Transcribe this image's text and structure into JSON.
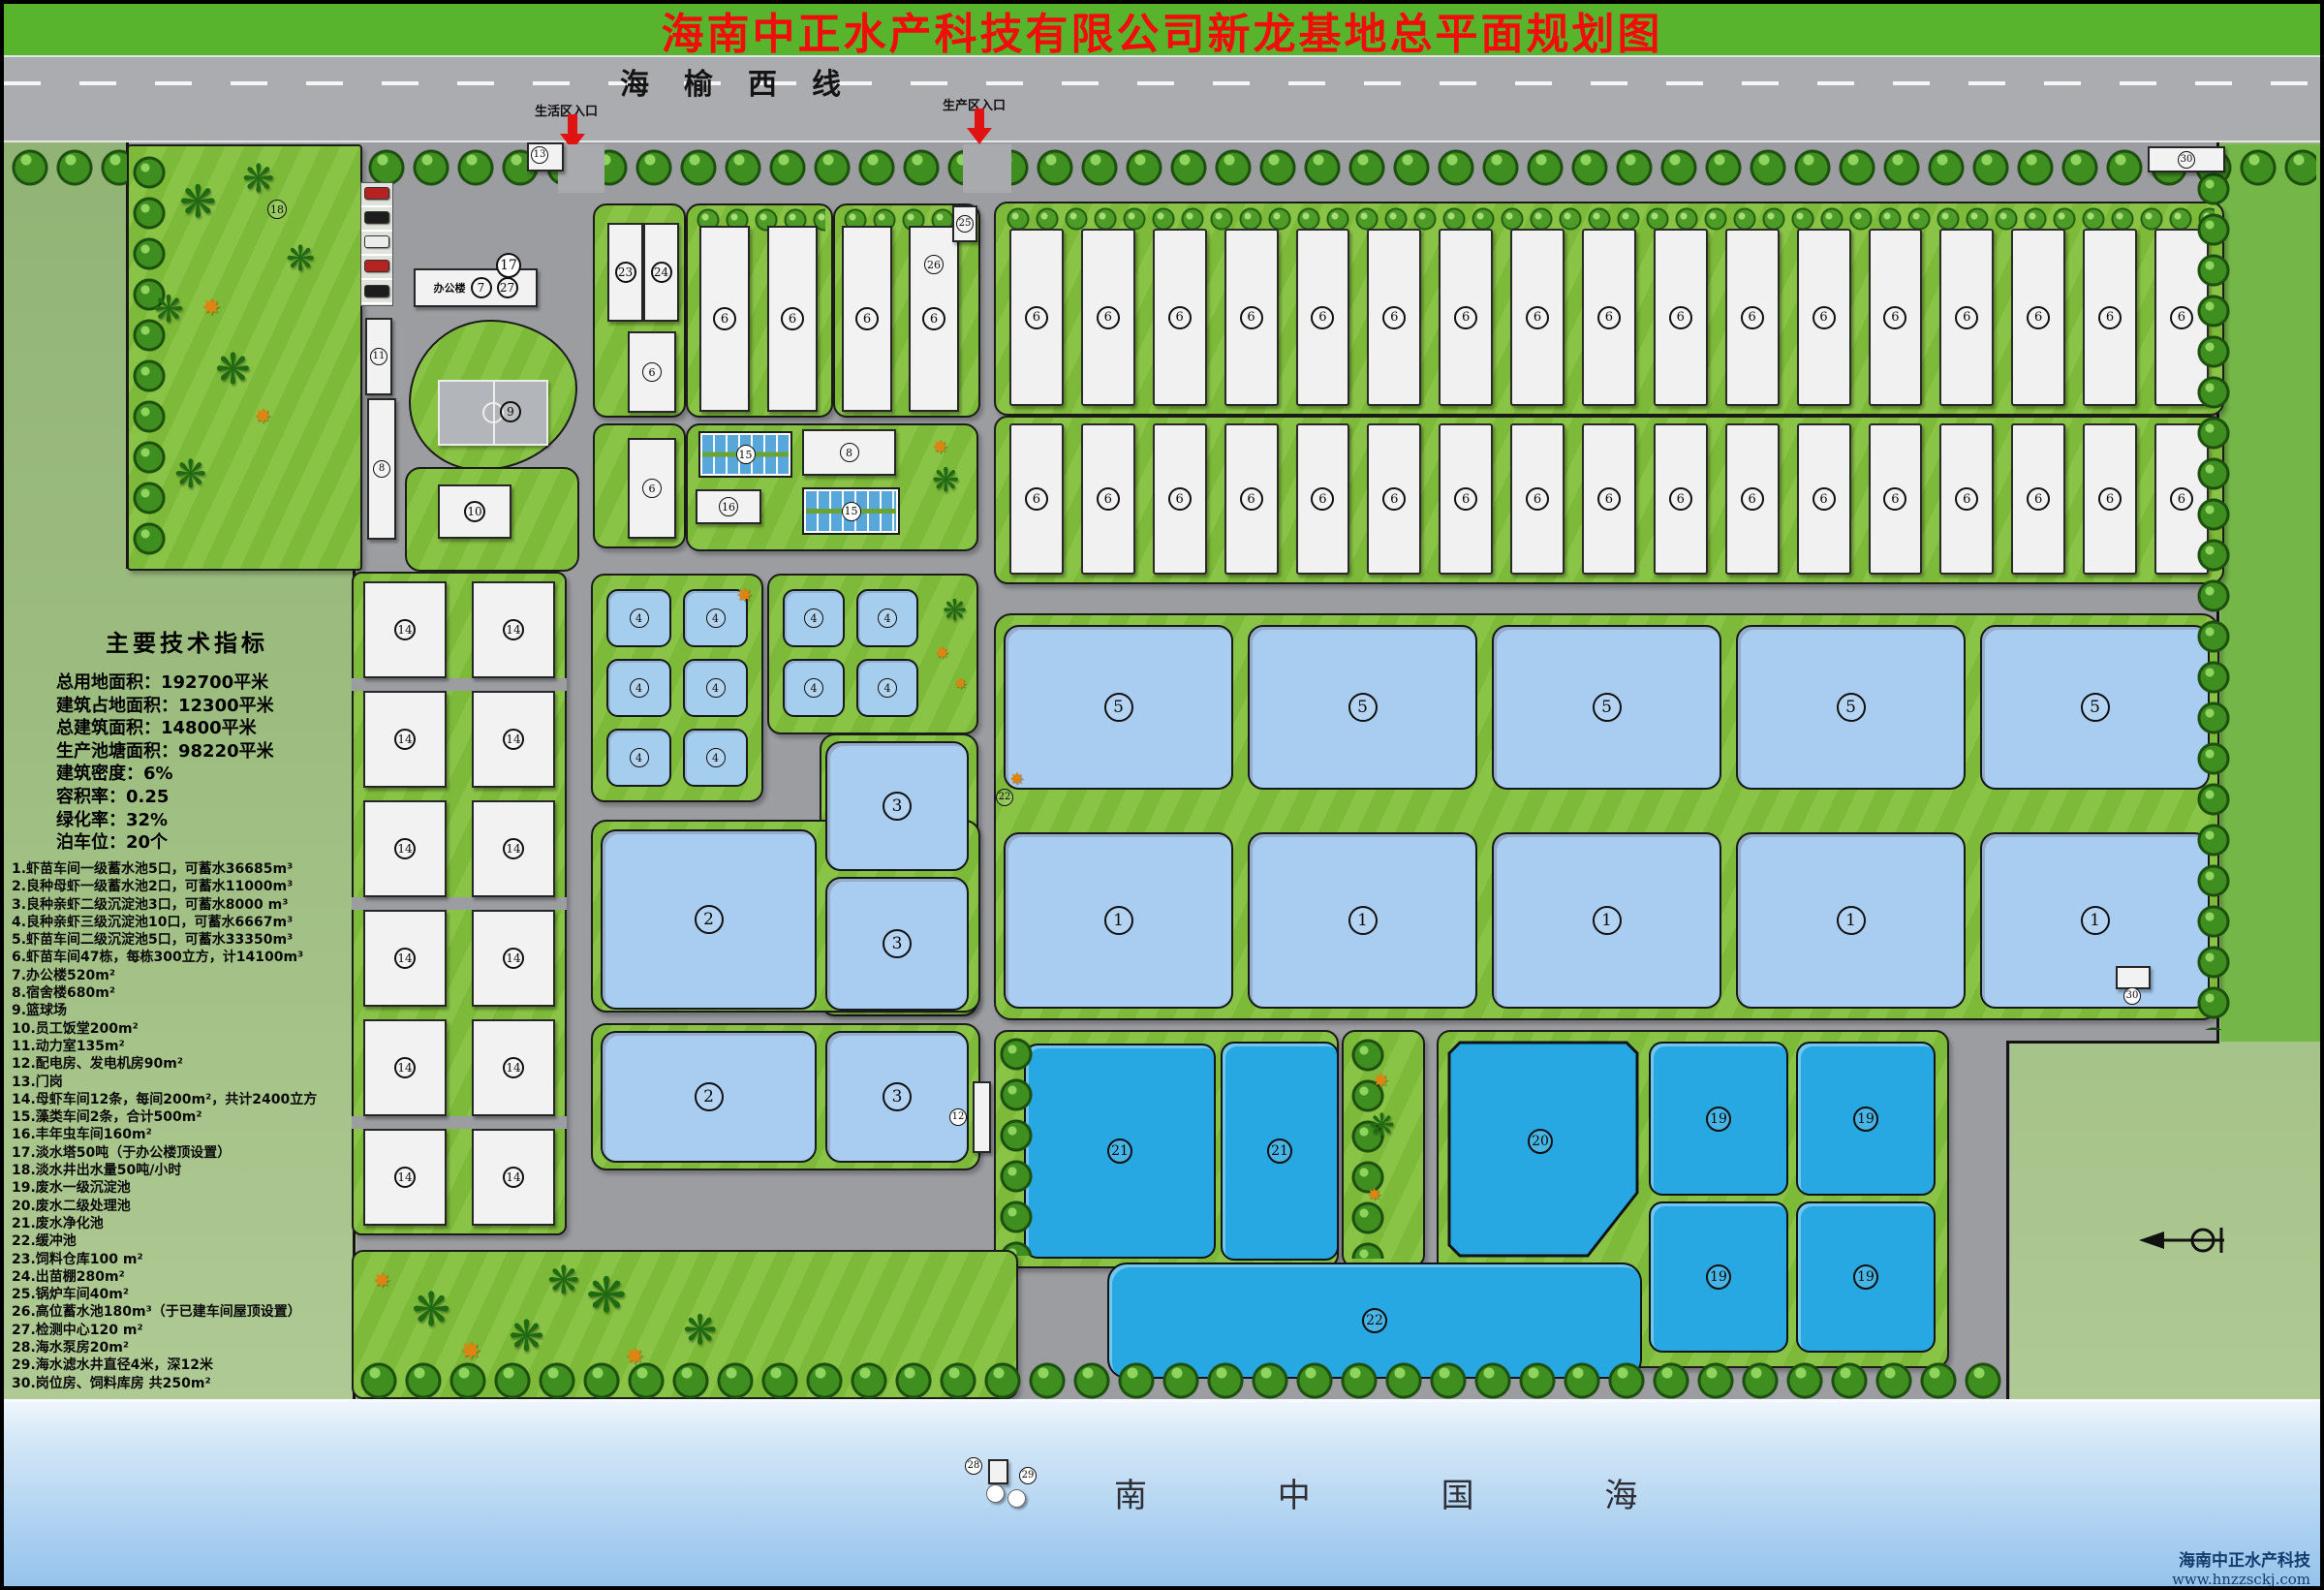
{
  "title": "海南中正水产科技有限公司新龙基地总平面规划图",
  "road": {
    "name": "海榆西线",
    "entrance_left": "生活区入口",
    "entrance_right": "生产区入口"
  },
  "indicators": {
    "title": "主要技术指标",
    "lines": [
      "总用地面积：192700平米",
      "建筑占地面积：12300平米",
      "总建筑面积：14800平米",
      "生产池塘面积：98220平米",
      "建筑密度：6%",
      "容积率：0.25",
      "绿化率：32%",
      "泊车位：20个"
    ]
  },
  "legend": [
    "1.虾苗车间一级蓄水池5口，可蓄水36685m³",
    "2.良种母虾一级蓄水池2口，可蓄水11000m³",
    "3.良种亲虾二级沉淀池3口，可蓄水8000 m³",
    "4.良种亲虾三级沉淀池10口，可蓄水6667m³",
    "5.虾苗车间二级沉淀池5口，可蓄水33350m³",
    "6.虾苗车间47栋，每栋300立方，计14100m³",
    "7.办公楼520m²",
    "8.宿舍楼680m²",
    "9.篮球场",
    "10.员工饭堂200m²",
    "11.动力室135m²",
    "12.配电房、发电机房90m²",
    "13.门岗",
    "14.母虾车间12条，每间200m²，共计2400立方",
    "15.藻类车间2条，合计500m²",
    "16.丰年虫车间160m²",
    "17.淡水塔50吨（于办公楼顶设置）",
    "18.淡水井出水量50吨/小时",
    "19.废水一级沉淀池",
    "20.废水二级处理池",
    "21.废水净化池",
    "22.缓冲池",
    "23.饲料仓库100 m²",
    "24.出苗棚280m²",
    "25.锅炉车间40m²",
    "26.高位蓄水池180m³（于已建车间屋顶设置）",
    "27.检测中心120 m²",
    "28.海水泵房20m²",
    "29.海水滤水井直径4米，深12米",
    "30.岗位房、饲料库房 共250m²"
  ],
  "labels": {
    "office": "办公楼"
  },
  "markers": {
    "n1": "1",
    "n2": "2",
    "n3": "3",
    "n4": "4",
    "n5": "5",
    "n6": "6",
    "n7": "7",
    "n8": "8",
    "n9": "9",
    "n10": "10",
    "n11": "11",
    "n12": "12",
    "n13": "13",
    "n14": "14",
    "n15": "15",
    "n16": "16",
    "n17": "17",
    "n18": "18",
    "n19": "19",
    "n20": "20",
    "n21": "21",
    "n22": "22",
    "n23": "23",
    "n24": "24",
    "n25": "25",
    "n26": "26",
    "n27": "27",
    "n28": "28",
    "n29": "29",
    "n30": "30"
  },
  "sea": {
    "name": "南 中 国 海"
  },
  "footer": {
    "company": "海南中正水产科技",
    "website": "www.hnzzsckj.com"
  },
  "colors": {
    "title_red": "#f20d0d",
    "banner_green": "#58b32d",
    "pond_light": "#a9cdf1",
    "pond_cyan": "#27a8e2",
    "road_gray": "#9b9da1"
  },
  "deco": {
    "palm": "❋",
    "shrub": "✸"
  }
}
